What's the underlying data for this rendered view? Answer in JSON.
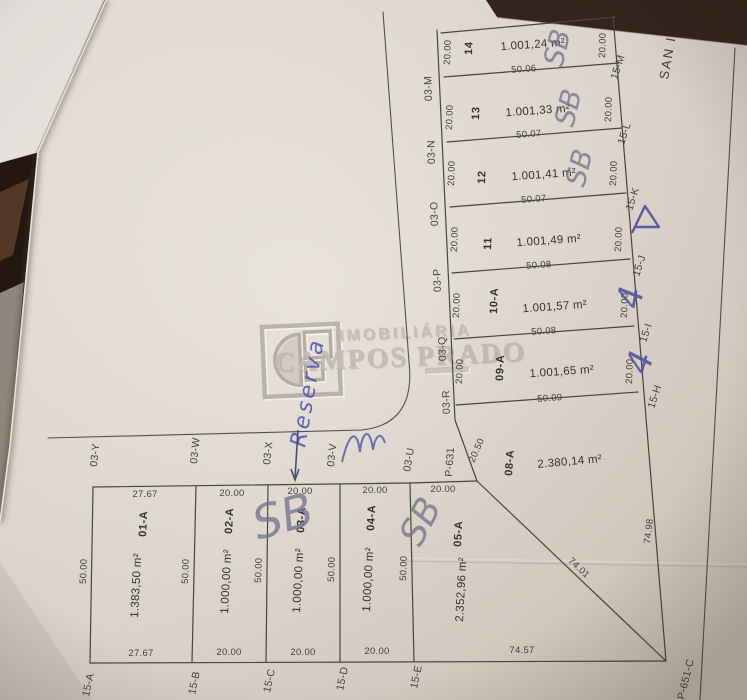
{
  "photo": {
    "background_color": "#2b1c15",
    "paper_color": "#e8e3dc",
    "ink_color": "#45423d",
    "handwriting_color": "#4a52a8"
  },
  "watermark": {
    "line1": "IMOBILIÁRIA",
    "line2": "CAMPOS PRADO"
  },
  "street_sign_right": "SAN I",
  "plat": {
    "left_lots": [
      {
        "number": "01-A",
        "area": "1.383,50 m²",
        "front": "27.67",
        "rear": "27.67",
        "pin_top": "03-Y",
        "pin_bottom": "15-A"
      },
      {
        "number": "02-A",
        "area": "1.000,00 m²",
        "front": "20.00",
        "rear": "20.00",
        "pin_top": "03-W",
        "pin_bottom": "15-B"
      },
      {
        "number": "03-A",
        "area": "1.000,00 m²",
        "front": "20.00",
        "rear": "20.00",
        "pin_top": "03-X",
        "pin_bottom": "15-C"
      },
      {
        "number": "04-A",
        "area": "1.000,00 m²",
        "front": "20.00",
        "rear": "20.00",
        "pin_top": "03-V",
        "pin_bottom": "15-D"
      },
      {
        "number": "05-A",
        "area": "2.352,96 m²",
        "front": "20.00",
        "rear": "74.57",
        "pin_top": "03-U",
        "pin_bottom": "15-E",
        "diagonal": "74.01"
      }
    ],
    "left_depths": [
      "50.00",
      "50.00",
      "50.00",
      "50.00",
      "50.00"
    ],
    "right_lots": [
      {
        "number": "14",
        "area": "1.001,24 m²",
        "side_left": "20.00",
        "side_right": "20.00",
        "depth_below": "50.06",
        "pin_left": "03-M",
        "pin_right": "15-M"
      },
      {
        "number": "13",
        "area": "1.001,33 m²",
        "side_left": "20.00",
        "side_right": "20.00",
        "depth_below": "50.07",
        "pin_left": "03-N",
        "pin_right": "15-L"
      },
      {
        "number": "12",
        "area": "1.001,41 m²",
        "side_left": "20.00",
        "side_right": "20.00",
        "depth_below": "50.07",
        "pin_left": "03-O",
        "pin_right": "15-K"
      },
      {
        "number": "11",
        "area": "1.001,49 m²",
        "side_left": "20.00",
        "side_right": "20.00",
        "depth_below": "50.08",
        "pin_left": "03-P",
        "pin_right": "15-J"
      },
      {
        "number": "10-A",
        "area": "1.001,57 m²",
        "side_left": "20.00",
        "side_right": "20.00",
        "depth_below": "50.08",
        "pin_left": "03-Q",
        "pin_right": "15-I"
      },
      {
        "number": "09-A",
        "area": "1.001,65 m²",
        "side_left": "20.00",
        "side_right": "20.00",
        "depth_below": "50.09",
        "pin_left": "03-R",
        "pin_right": "15-H"
      },
      {
        "number": "08-A",
        "area": "2.380,14 m²",
        "side_left": "20.50",
        "side_right": "74.98"
      }
    ],
    "corner_points": {
      "p631": "P-631",
      "p651c": "P-651-C"
    }
  },
  "handwriting": {
    "sb": "SB",
    "reserve_note": "Reserva",
    "mark_four": "4"
  }
}
